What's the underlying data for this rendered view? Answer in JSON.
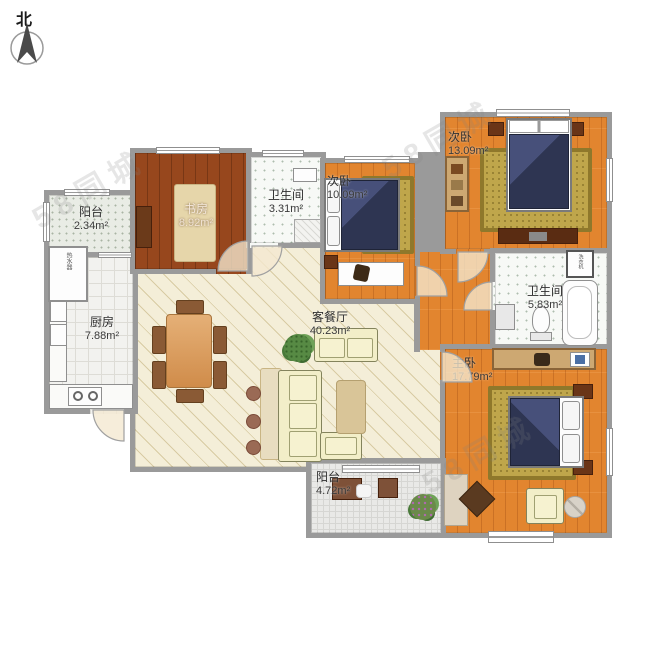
{
  "compass": {
    "label": "北"
  },
  "rooms": [
    {
      "name": "阳台",
      "area": "2.34m²"
    },
    {
      "name": "厨房",
      "area": "7.88m²"
    },
    {
      "name": "书房",
      "area": "8.92m²"
    },
    {
      "name": "卫生间",
      "area": "3.31m²"
    },
    {
      "name": "次卧",
      "area": "10.09m²"
    },
    {
      "name": "次卧",
      "area": "13.09m²"
    },
    {
      "name": "卫生间",
      "area": "5.83m²"
    },
    {
      "name": "客餐厅",
      "area": "40.23m²"
    },
    {
      "name": "主卧",
      "area": "17.79m²"
    },
    {
      "name": "阳台",
      "area": "4.72m²"
    }
  ],
  "appliances": {
    "washer": "洗衣机",
    "water_heater": "热水器"
  },
  "watermark": {
    "text": "58同城"
  },
  "colors": {
    "wall": "#9a9a9a",
    "wood": "#e2852f",
    "study_wood": "#97471d",
    "living_floor": "#f4eed8",
    "rug": "#bfa64b",
    "bed": "#2e3552"
  }
}
